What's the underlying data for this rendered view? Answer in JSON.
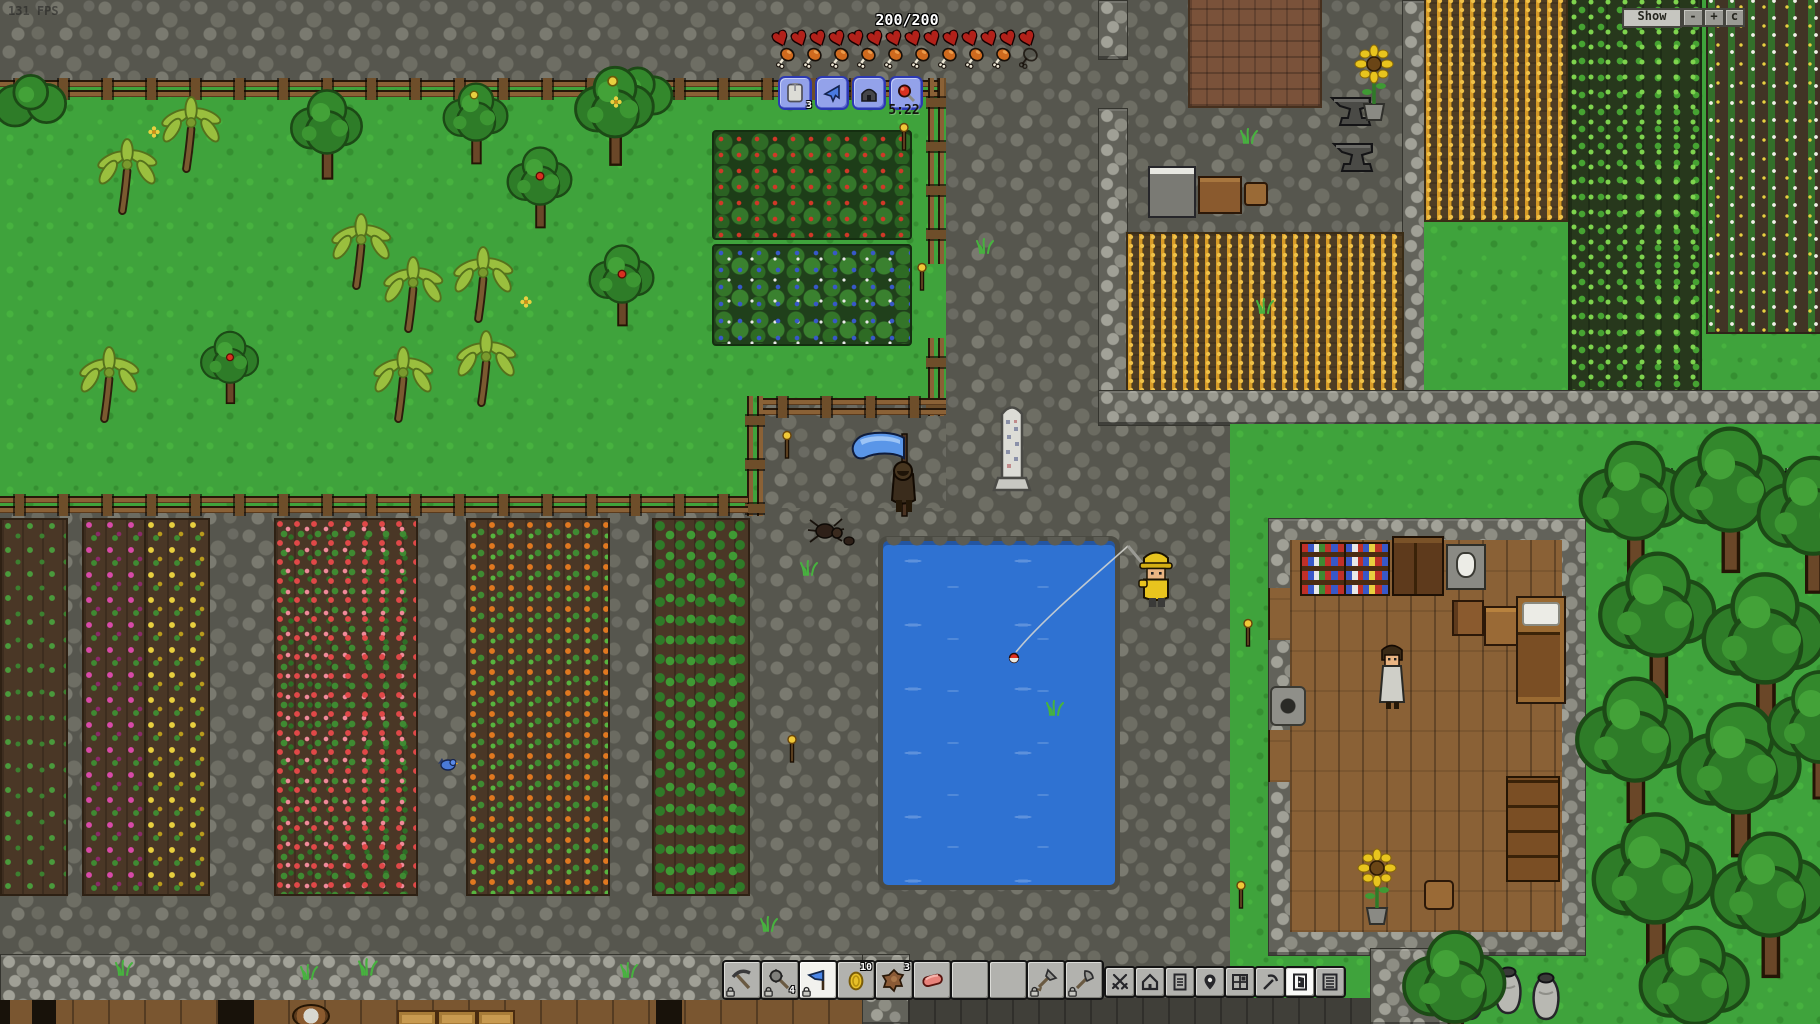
{
  "hud": {
    "fps": "131 FPS",
    "health_label": "200/200",
    "hearts": 14,
    "food_full": 9,
    "food_empty": 1,
    "journal_glyph": "T",
    "journal_badge": "3",
    "clock": "5:22",
    "button_icons": [
      "journal-tablet",
      "horn",
      "home",
      "magnifier-red"
    ]
  },
  "minimap": {
    "show": "Show",
    "zoom_out": "-",
    "zoom_in": "+",
    "center": "c"
  },
  "hotbar": {
    "slots": [
      {
        "item": "pickaxe",
        "locked": true
      },
      {
        "item": "mace",
        "count": "4",
        "locked": true
      },
      {
        "item": "blue-banner",
        "locked": true,
        "selected": true
      },
      {
        "item": "gold-coin",
        "count": "10"
      },
      {
        "item": "animal-hide",
        "count": "3"
      },
      {
        "item": "raw-meat"
      },
      {
        "item": "empty"
      },
      {
        "item": "empty"
      },
      {
        "item": "shovel",
        "locked": true
      },
      {
        "item": "axe",
        "locked": true
      }
    ]
  },
  "menu": {
    "items": [
      "pvp-swords",
      "settlement-home",
      "quest-document",
      "map-pin",
      "inventory-grid",
      "mining-pickaxe",
      "housing-door",
      "settlement-log"
    ],
    "active": "housing-door"
  },
  "scene": {
    "npcs": [
      "banner-knight",
      "fisherman",
      "villager",
      "spider"
    ],
    "water": "pond",
    "clock_time_of_day": "5:22"
  }
}
